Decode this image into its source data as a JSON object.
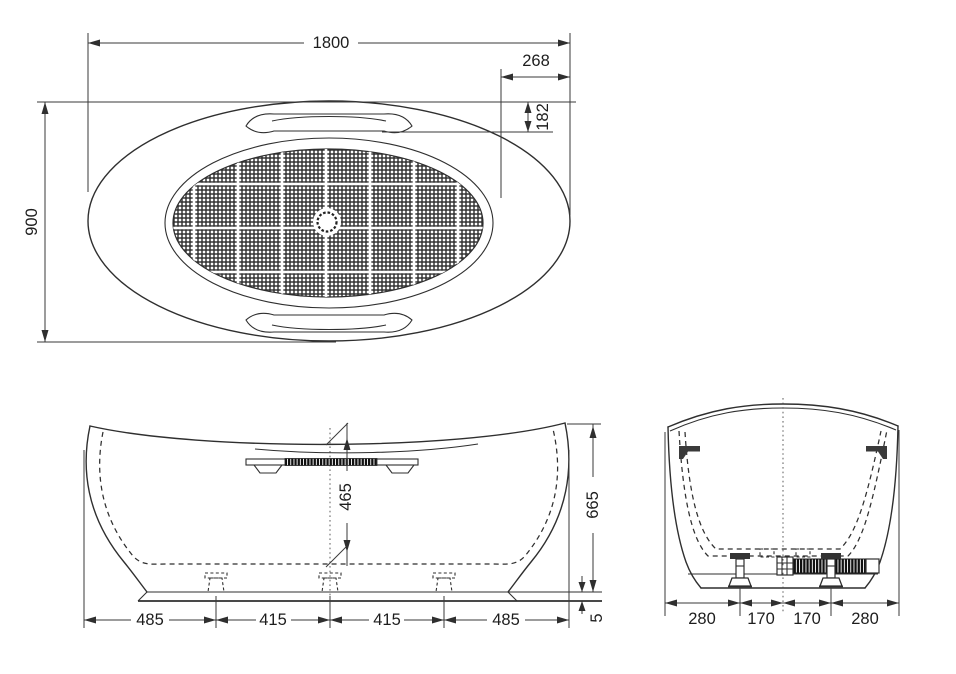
{
  "drawing": {
    "background": "#ffffff",
    "line_color": "#2f2f2f",
    "top_view": {
      "overall_length": "1800",
      "right_inset": "268",
      "grip_inset": "182",
      "overall_width": "900"
    },
    "front_view": {
      "interior_depth": "465",
      "overall_height": "665",
      "base_plate": "5",
      "chain": [
        "485",
        "415",
        "415",
        "485"
      ]
    },
    "side_view": {
      "chain": [
        "280",
        "170",
        "170",
        "280"
      ]
    }
  }
}
